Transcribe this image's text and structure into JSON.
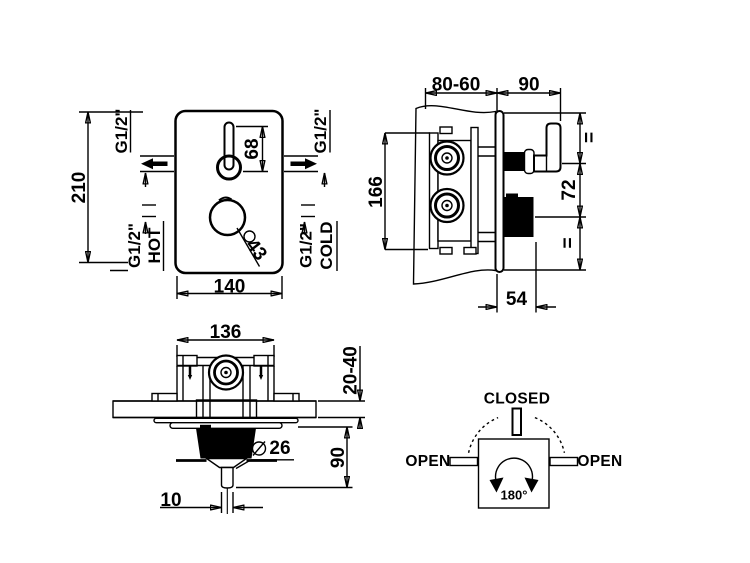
{
  "sheet": {
    "background": "#ffffff",
    "line_color": "#000000"
  },
  "front_view": {
    "dim_height": "210",
    "dim_width": "140",
    "dim_lever": "68",
    "dim_knob_diameter": "43",
    "port_top_left": "G1/2\"",
    "port_top_right": "G1/2\"",
    "port_bottom_left": "G1/2\"",
    "port_bottom_left_name": "HOT",
    "port_bottom_right": "G1/2\"",
    "port_bottom_right_name": "COLD"
  },
  "side_view": {
    "dim_depth_range": "80-60",
    "dim_handle_projection": "90",
    "dim_body_height": "166",
    "dim_handle_to_knob": "72",
    "equal_top": "=",
    "equal_bottom": "=",
    "dim_knob_projection": "54"
  },
  "plan_view": {
    "dim_body_width": "136",
    "dim_wall_thickness_range": "20-40",
    "dim_projection": "90",
    "dim_spout_diameter": "26",
    "dim_stem_width": "10"
  },
  "rotation_diagram": {
    "closed_label": "CLOSED",
    "open_left_label": "OPEN",
    "open_right_label": "OPEN",
    "angle_label": "180°"
  }
}
